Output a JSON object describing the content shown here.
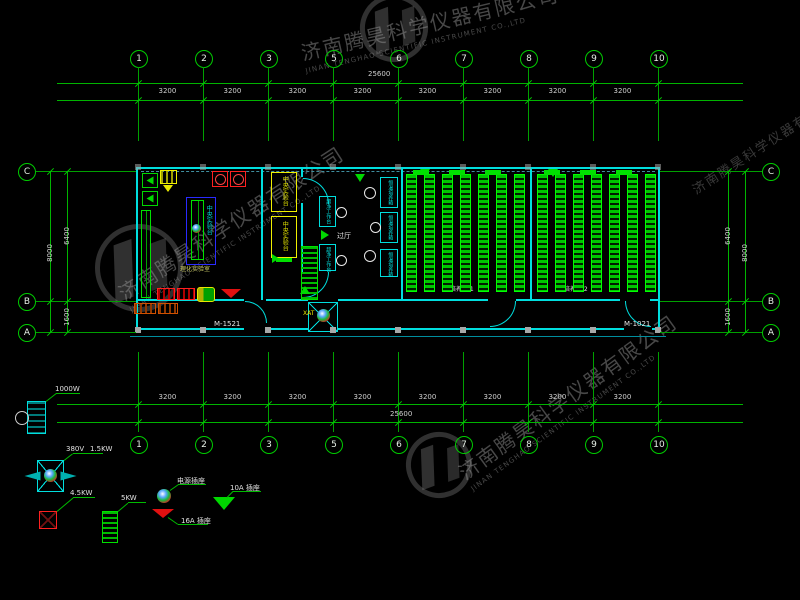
{
  "grid": {
    "columns": [
      "1",
      "2",
      "3",
      "5",
      "6",
      "7",
      "8",
      "9",
      "10"
    ],
    "rows": [
      "C",
      "B",
      "A"
    ],
    "bay_dims": [
      "3200",
      "3200",
      "3200",
      "3200",
      "3200",
      "3200",
      "3200",
      "3200"
    ],
    "total_dim": "25600",
    "left_dims": {
      "total": "8000",
      "upper": "6400",
      "lower": "1600"
    },
    "right_dims": {
      "total": "8000",
      "upper": "6400",
      "lower": "1600"
    }
  },
  "plan": {
    "door_left_label": "M-1521",
    "door_right_label": "M-1021",
    "entrance_label": "XAT",
    "hall_label": "过厅",
    "central_bench_label": "中央实验台",
    "room_left_label": "理化实验室",
    "clean_bench_label": "超净工作台",
    "incubator_label": "恒温培养箱",
    "room1_label": "培养室 1",
    "room2_label": "培养室 2"
  },
  "legend": {
    "dryer_power": "1000W",
    "voltage": "380V",
    "motor_power": "1.5KW",
    "hood_power": "4.5KW",
    "rack_power": "5KW",
    "socket_label": "电源插座",
    "socket16_label": "16A 插座",
    "socket10_label": "10A 插座"
  },
  "watermark": {
    "company_cn": "济南腾昊科学仪器有限公司",
    "company_en": "JINAN TENGHAO SCIENTIFIC INSTRUMENT CO.,LTD"
  },
  "colors": {
    "axis_green": "#00a800",
    "bench_green": "#00ff00",
    "wall_cyan": "#00dede",
    "accent_yellow": "#f0f000",
    "alert_red": "#ff2020",
    "background": "#000000"
  }
}
